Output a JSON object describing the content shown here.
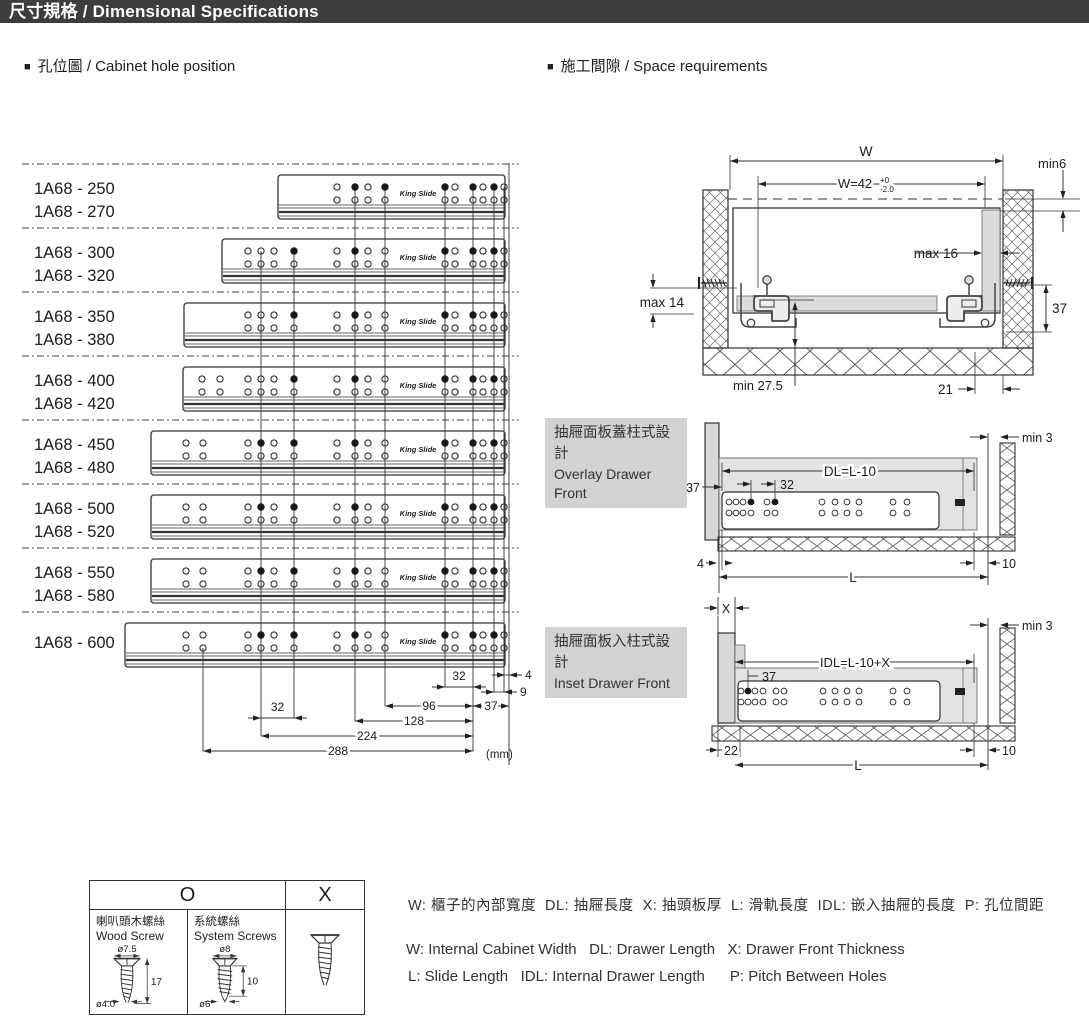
{
  "header": {
    "title": "尺寸規格 / Dimensional Specifications"
  },
  "sections": {
    "left": {
      "bullet": "■",
      "label": "孔位圖 / Cabinet hole position"
    },
    "right": {
      "bullet": "■",
      "label": "施工間隙 / Space requirements"
    }
  },
  "hole_chart": {
    "brand": "King Slide",
    "unit": "(mm)",
    "right_edge": 505,
    "separators_y": [
      164,
      228,
      292,
      356,
      420,
      484,
      548,
      612
    ],
    "rows": [
      {
        "labels": [
          "1A68 - 250",
          "1A68 - 270"
        ],
        "top": 175,
        "left": 278,
        "holes": [
          [
            337,
            0
          ],
          [
            355,
            1
          ],
          [
            368,
            0
          ],
          [
            385,
            1
          ],
          [
            445,
            1
          ],
          [
            455,
            0
          ],
          [
            473,
            1
          ],
          [
            483,
            0
          ],
          [
            494,
            1
          ],
          [
            504,
            0
          ]
        ]
      },
      {
        "labels": [
          "1A68 - 300",
          "1A68 - 320"
        ],
        "top": 239,
        "left": 222,
        "holes": [
          [
            248,
            0
          ],
          [
            261,
            0
          ],
          [
            274,
            0
          ],
          [
            294,
            1
          ],
          [
            337,
            0
          ],
          [
            355,
            1
          ],
          [
            368,
            0
          ],
          [
            385,
            0
          ],
          [
            445,
            1
          ],
          [
            455,
            0
          ],
          [
            473,
            1
          ],
          [
            483,
            0
          ],
          [
            494,
            1
          ],
          [
            504,
            0
          ]
        ]
      },
      {
        "labels": [
          "1A68 - 350",
          "1A68 - 380"
        ],
        "top": 303,
        "left": 184,
        "holes": [
          [
            248,
            0
          ],
          [
            261,
            0
          ],
          [
            274,
            0
          ],
          [
            294,
            1
          ],
          [
            337,
            0
          ],
          [
            355,
            1
          ],
          [
            368,
            0
          ],
          [
            385,
            0
          ],
          [
            445,
            1
          ],
          [
            455,
            0
          ],
          [
            473,
            1
          ],
          [
            483,
            0
          ],
          [
            494,
            1
          ],
          [
            504,
            0
          ]
        ]
      },
      {
        "labels": [
          "1A68 - 400",
          "1A68 - 420"
        ],
        "top": 367,
        "left": 183,
        "holes": [
          [
            202,
            0
          ],
          [
            220,
            0
          ],
          [
            248,
            0
          ],
          [
            261,
            0
          ],
          [
            274,
            0
          ],
          [
            294,
            1
          ],
          [
            337,
            0
          ],
          [
            355,
            1
          ],
          [
            368,
            0
          ],
          [
            385,
            0
          ],
          [
            445,
            1
          ],
          [
            455,
            0
          ],
          [
            473,
            1
          ],
          [
            483,
            0
          ],
          [
            494,
            1
          ],
          [
            504,
            0
          ]
        ]
      },
      {
        "labels": [
          "1A68 - 450",
          "1A68 - 480"
        ],
        "top": 431,
        "left": 151,
        "holes": [
          [
            186,
            0
          ],
          [
            203,
            0
          ],
          [
            248,
            0
          ],
          [
            261,
            1
          ],
          [
            274,
            0
          ],
          [
            294,
            1
          ],
          [
            337,
            0
          ],
          [
            355,
            1
          ],
          [
            368,
            0
          ],
          [
            385,
            0
          ],
          [
            445,
            1
          ],
          [
            455,
            0
          ],
          [
            473,
            1
          ],
          [
            483,
            0
          ],
          [
            494,
            1
          ],
          [
            504,
            0
          ]
        ]
      },
      {
        "labels": [
          "1A68 - 500",
          "1A68 - 520"
        ],
        "top": 495,
        "left": 151,
        "holes": [
          [
            186,
            0
          ],
          [
            203,
            0
          ],
          [
            248,
            0
          ],
          [
            261,
            1
          ],
          [
            274,
            0
          ],
          [
            294,
            1
          ],
          [
            337,
            0
          ],
          [
            355,
            1
          ],
          [
            368,
            0
          ],
          [
            385,
            0
          ],
          [
            445,
            1
          ],
          [
            455,
            0
          ],
          [
            473,
            1
          ],
          [
            483,
            0
          ],
          [
            494,
            1
          ],
          [
            504,
            0
          ]
        ]
      },
      {
        "labels": [
          "1A68 - 550",
          "1A68 - 580"
        ],
        "top": 559,
        "left": 151,
        "holes": [
          [
            186,
            0
          ],
          [
            203,
            0
          ],
          [
            248,
            0
          ],
          [
            261,
            1
          ],
          [
            274,
            0
          ],
          [
            294,
            1
          ],
          [
            337,
            0
          ],
          [
            355,
            1
          ],
          [
            368,
            0
          ],
          [
            385,
            0
          ],
          [
            445,
            1
          ],
          [
            455,
            0
          ],
          [
            473,
            1
          ],
          [
            483,
            0
          ],
          [
            494,
            1
          ],
          [
            504,
            0
          ]
        ]
      },
      {
        "labels": [
          "1A68 - 600"
        ],
        "top": 623,
        "left": 125,
        "holes": [
          [
            186,
            0
          ],
          [
            203,
            0
          ],
          [
            248,
            0
          ],
          [
            261,
            1
          ],
          [
            274,
            0
          ],
          [
            294,
            1
          ],
          [
            337,
            0
          ],
          [
            355,
            1
          ],
          [
            368,
            0
          ],
          [
            385,
            0
          ],
          [
            445,
            1
          ],
          [
            455,
            0
          ],
          [
            473,
            1
          ],
          [
            483,
            0
          ],
          [
            494,
            1
          ],
          [
            504,
            0
          ]
        ]
      }
    ],
    "vlines": [
      [
        203,
        648,
        751
      ],
      [
        261,
        251,
        736
      ],
      [
        294,
        251,
        718
      ],
      [
        355,
        187,
        721
      ],
      [
        385,
        187,
        706
      ],
      [
        445,
        187,
        687
      ],
      [
        473,
        187,
        751
      ],
      [
        494,
        187,
        692
      ],
      [
        504,
        187,
        692
      ],
      [
        509,
        163,
        765
      ]
    ],
    "dims": [
      {
        "label": "32",
        "x1": 261,
        "x2": 294,
        "y": 718,
        "style": "out-above"
      },
      {
        "label": "32",
        "x1": 445,
        "x2": 473,
        "y": 687,
        "style": "out-above"
      },
      {
        "label": "4",
        "x1": 505,
        "x2": 509,
        "y": 675,
        "style": "out-right"
      },
      {
        "label": "9",
        "x1": 494,
        "x2": 504,
        "y": 692,
        "style": "out-right"
      },
      {
        "label": "96",
        "x1": 385,
        "x2": 473,
        "y": 706,
        "style": "in"
      },
      {
        "label": "37",
        "x1": 473,
        "x2": 509,
        "y": 706,
        "style": "in"
      },
      {
        "label": "128",
        "x1": 355,
        "x2": 473,
        "y": 721,
        "style": "in"
      },
      {
        "label": "224",
        "x1": 261,
        "x2": 473,
        "y": 736,
        "style": "in"
      },
      {
        "label": "288",
        "x1": 203,
        "x2": 473,
        "y": 751,
        "style": "in"
      }
    ]
  },
  "space": {
    "top": {
      "w": "W",
      "w42": "W=42",
      "tol_up": "+0",
      "tol_dn": "-2.0",
      "min6": "min6",
      "max16": "max 16",
      "max14": "max 14",
      "d37": "37",
      "min275": "min 27.5",
      "d21": "21"
    },
    "overlay": {
      "title_zh": "抽屜面板蓋柱式設計",
      "title_en": "Overlay Drawer Front",
      "dl": "DL=L-10",
      "d37": "37",
      "d32": "32",
      "min3": "min 3",
      "d4": "4",
      "d10": "10",
      "L": "L"
    },
    "inset": {
      "title_zh": "抽屜面板入柱式設計",
      "title_en": "Inset Drawer Front",
      "x": "X",
      "idl": "IDL=L-10+X",
      "d37": "37",
      "min3": "min 3",
      "d22": "22",
      "d10": "10",
      "L": "L"
    }
  },
  "screw_table": {
    "o": "O",
    "x": "X",
    "wood": {
      "zh": "喇叭頭木螺絲",
      "en": "Wood Screw",
      "d_head": "ø7.5",
      "len": "17",
      "d_shank": "ø4.0"
    },
    "system": {
      "zh": "系統螺絲",
      "en": "System Screws",
      "d_head": "ø8",
      "len": "10",
      "d_shank": "ø6"
    }
  },
  "legend": {
    "zh": "W: 櫃子的內部寬度  DL: 抽屜長度  X: 抽頭板厚  L: 滑軌長度  IDL: 嵌入抽屜的長度  P: 孔位間距",
    "en1": "W: Internal Cabinet Width   DL: Drawer Length   X: Drawer Front Thickness",
    "en2": "L: Slide Length   IDL: Internal Drawer Length      P: Pitch Between Holes"
  }
}
